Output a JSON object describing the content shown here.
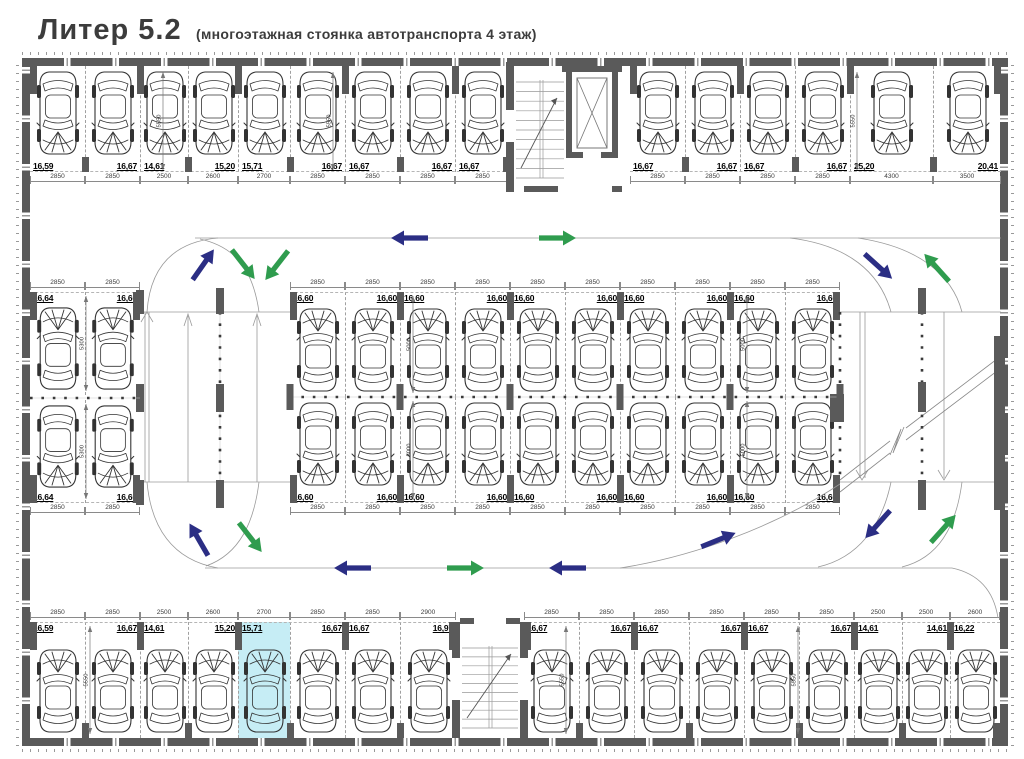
{
  "title": {
    "main": "Литер 5.2",
    "subtitle": "(многоэтажная стоянка автотранспорта 4 этаж)"
  },
  "colors": {
    "wall": "#5a5a5a",
    "down_arrow": "#2b2e84",
    "up_arrow": "#2f9c4e",
    "highlight": "#c6edf5"
  },
  "depth_values": {
    "outer_row": "5550",
    "island_row": "5000",
    "left_block": "5300"
  },
  "parking_rows": {
    "top_left": {
      "stalls": [
        {
          "area": "16,59",
          "width_mm": "2850"
        },
        {
          "area": "16,67",
          "width_mm": "2850"
        },
        {
          "area": "14,61",
          "width_mm": "2500"
        },
        {
          "area": "15,20",
          "width_mm": "2600"
        },
        {
          "area": "15,71",
          "width_mm": "2700"
        },
        {
          "area": "16,67",
          "width_mm": "2850"
        },
        {
          "area": "16,67",
          "width_mm": "2850"
        },
        {
          "area": "16,67",
          "width_mm": "2850"
        },
        {
          "area": "16,67",
          "width_mm": "2850"
        }
      ]
    },
    "top_right": {
      "stalls": [
        {
          "area": "16,67",
          "width_mm": "2850"
        },
        {
          "area": "16,67",
          "width_mm": "2850"
        },
        {
          "area": "16,67",
          "width_mm": "2850"
        },
        {
          "area": "16,67",
          "width_mm": "2850"
        },
        {
          "area": "25,20",
          "width_mm": "4300"
        },
        {
          "area": "20,41",
          "width_mm": "3500"
        }
      ]
    },
    "left_block_top": {
      "stalls": [
        {
          "area": "16,64",
          "width_mm": "2850"
        },
        {
          "area": "16,60",
          "width_mm": "2850"
        }
      ]
    },
    "left_block_bottom": {
      "stalls": [
        {
          "area": "16,64",
          "width_mm": "2850"
        },
        {
          "area": "16,60",
          "width_mm": "2850"
        }
      ]
    },
    "island_top": {
      "stalls": [
        {
          "area": "16,60",
          "width_mm": "2850"
        },
        {
          "area": "16,60",
          "width_mm": "2850"
        },
        {
          "area": "16,60",
          "width_mm": "2850"
        },
        {
          "area": "16,60",
          "width_mm": "2850"
        },
        {
          "area": "16,60",
          "width_mm": "2850"
        },
        {
          "area": "16,60",
          "width_mm": "2850"
        },
        {
          "area": "16,60",
          "width_mm": "2850"
        },
        {
          "area": "16,60",
          "width_mm": "2850"
        },
        {
          "area": "16,60",
          "width_mm": "2850"
        },
        {
          "area": "16,60",
          "width_mm": "2850"
        }
      ]
    },
    "island_bottom": {
      "stalls": [
        {
          "area": "16,60",
          "width_mm": "2850"
        },
        {
          "area": "16,60",
          "width_mm": "2850"
        },
        {
          "area": "16,60",
          "width_mm": "2850"
        },
        {
          "area": "16,60",
          "width_mm": "2850"
        },
        {
          "area": "16,60",
          "width_mm": "2850"
        },
        {
          "area": "16,60",
          "width_mm": "2850"
        },
        {
          "area": "16,60",
          "width_mm": "2850"
        },
        {
          "area": "16,60",
          "width_mm": "2850"
        },
        {
          "area": "16,60",
          "width_mm": "2850"
        },
        {
          "area": "16,60",
          "width_mm": "2850"
        }
      ]
    },
    "bottom_left": {
      "stalls": [
        {
          "area": "16,59",
          "width_mm": "2850"
        },
        {
          "area": "16,67",
          "width_mm": "2850"
        },
        {
          "area": "14,61",
          "width_mm": "2500"
        },
        {
          "area": "15,20",
          "width_mm": "2600"
        },
        {
          "area": "15,71",
          "width_mm": "2700",
          "highlighted": true
        },
        {
          "area": "16,67",
          "width_mm": "2850"
        },
        {
          "area": "16,67",
          "width_mm": "2850"
        },
        {
          "area": "16,97",
          "width_mm": "2900"
        }
      ]
    },
    "bottom_right": {
      "stalls": [
        {
          "area": "16,67",
          "width_mm": "2850"
        },
        {
          "area": "16,67",
          "width_mm": "2850"
        },
        {
          "area": "16,67",
          "width_mm": "2850"
        },
        {
          "area": "16,67",
          "width_mm": "2850"
        },
        {
          "area": "16,67",
          "width_mm": "2850"
        },
        {
          "area": "16,67",
          "width_mm": "2850"
        },
        {
          "area": "14,61",
          "width_mm": "2500"
        },
        {
          "area": "14,61",
          "width_mm": "2500"
        },
        {
          "area": "16,22",
          "width_mm": "2600"
        }
      ]
    }
  }
}
